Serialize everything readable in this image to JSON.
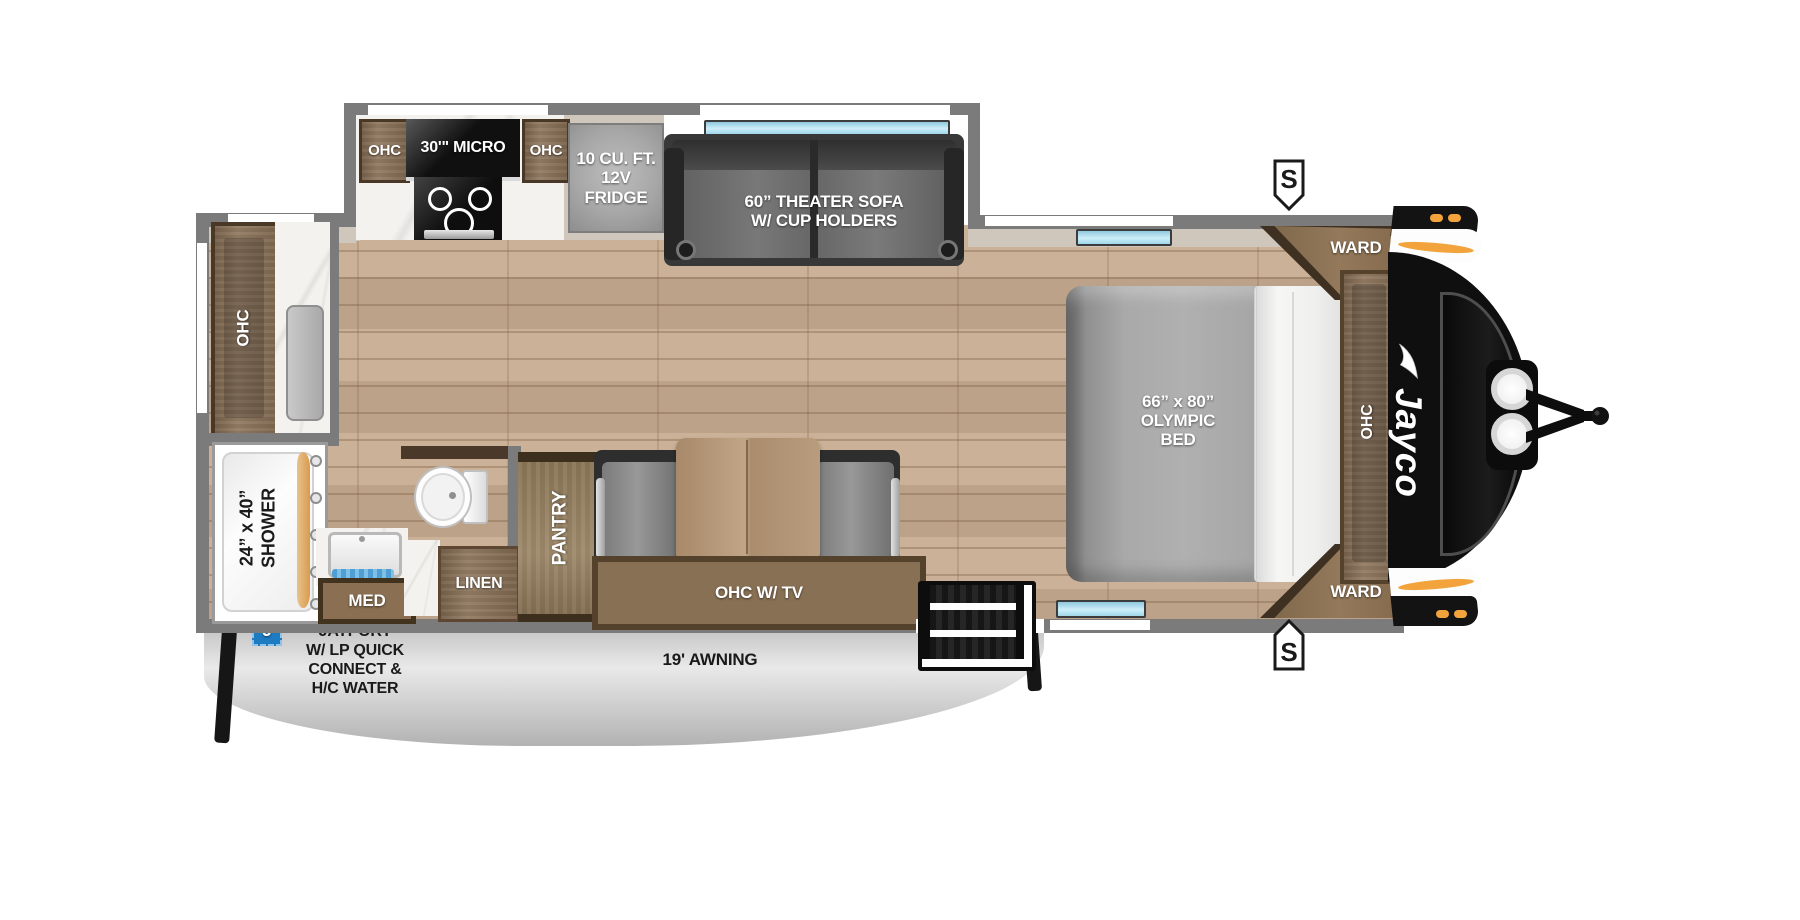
{
  "labels": {
    "slide_ohc_left": "OHC",
    "slide_micro": "30'\" MICRO",
    "slide_ohc_right": "OHC",
    "fridge": "10 CU. FT.\n12V FRIDGE",
    "theater_sofa": "60” THEATER SOFA\nW/ CUP HOLDERS",
    "rear_ohc": "OHC",
    "shower": "24” x 40”\nSHOWER",
    "med": "MED",
    "linen": "LINEN",
    "pantry": "PANTRY",
    "ohc_tv": "OHC W/ TV",
    "bed": "66” x 80”\nOLYMPIC\nBED",
    "ward_top": "WARD",
    "bedroom_ohc": "OHC",
    "ward_bottom": "WARD",
    "jayport_badge": "J",
    "jayport": "JAYPORT\nW/ LP QUICK\nCONNECT &\nH/C WATER",
    "awning": "19' AWNING",
    "marker_top": "S",
    "marker_bottom": "S",
    "brand": "Jayco"
  },
  "colors": {
    "accent_orange": "#F2A33C",
    "badge_blue": "#1D7CC1",
    "window_blue": "#AEDFF2",
    "wall_gray": "#7B7B7B",
    "cabinet_wood": "#8A7157",
    "floor_tan": "#C6AB8F",
    "cap_black": "#101010"
  }
}
